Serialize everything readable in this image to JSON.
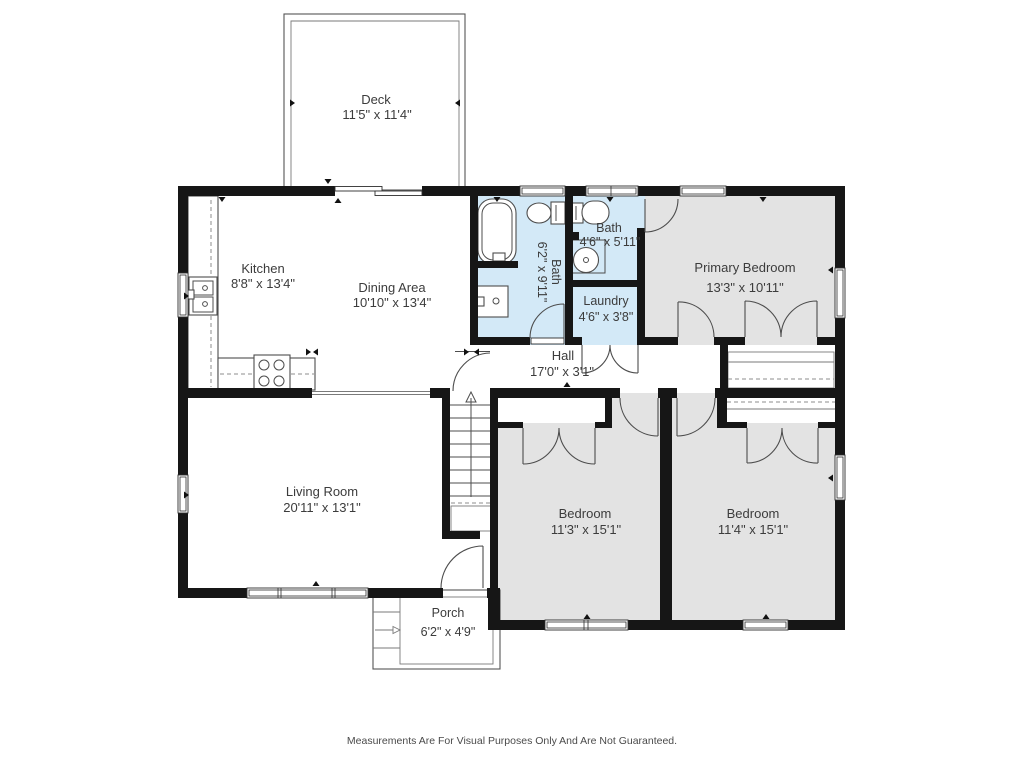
{
  "colors": {
    "wall": "#161616",
    "bath": "#d3e9f7",
    "bedroom": "#e3e3e3",
    "text": "#3c3c3c"
  },
  "rooms": {
    "deck": {
      "label": "Deck",
      "dims": "11'5\" x 11'4\""
    },
    "kitchen": {
      "label": "Kitchen",
      "dims": "8'8\" x 13'4\""
    },
    "dining": {
      "label": "Dining Area",
      "dims": "10'10\" x 13'4\""
    },
    "bath_main": {
      "label": "Bath",
      "dims": "6'2\" x 9'11\""
    },
    "bath_ensuite": {
      "label": "Bath",
      "dims": "4'6\" x 5'11\""
    },
    "laundry": {
      "label": "Laundry",
      "dims": "4'6\" x 3'8\""
    },
    "primary_bedroom": {
      "label": "Primary Bedroom",
      "dims": "13'3\" x 10'11\""
    },
    "hall": {
      "label": "Hall",
      "dims": "17'0\" x 3'1\""
    },
    "living_room": {
      "label": "Living Room",
      "dims": "20'11\" x 13'1\""
    },
    "bedroom_left": {
      "label": "Bedroom",
      "dims": "11'3\" x 15'1\""
    },
    "bedroom_right": {
      "label": "Bedroom",
      "dims": "11'4\" x 15'1\""
    },
    "porch": {
      "label": "Porch",
      "dims": "6'2\" x 4'9\""
    }
  },
  "footer": {
    "disclaimer": "Measurements Are For Visual Purposes Only And Are Not Guaranteed."
  }
}
